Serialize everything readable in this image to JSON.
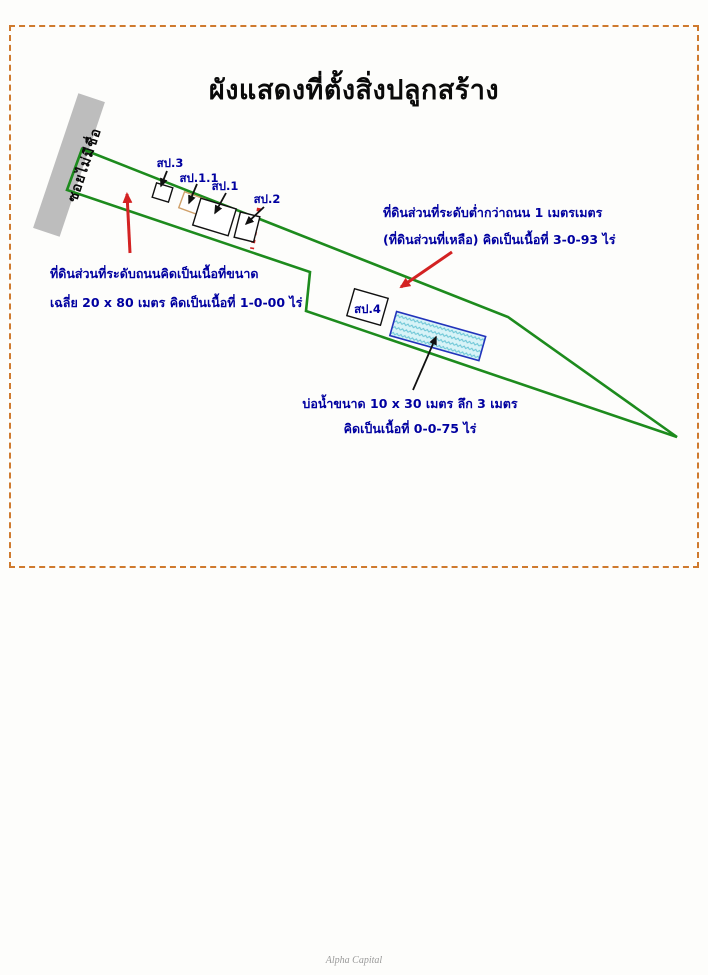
{
  "page": {
    "title": "ผังแสดงที่ตั้งสิ่งปลูกสร้าง",
    "footer": "Alpha Capital"
  },
  "road": {
    "label": "ซอยไม่มีชื่อ"
  },
  "buildings": [
    {
      "id": "sp3",
      "label": "สป.3"
    },
    {
      "id": "sp11",
      "label": "สป.1.1"
    },
    {
      "id": "sp1",
      "label": "สป.1"
    },
    {
      "id": "sp2",
      "label": "สป.2"
    },
    {
      "id": "sp4",
      "label": "สป.4"
    }
  ],
  "notes": {
    "road_level": {
      "line1": "ที่ดินส่วนที่ระดับถนนคิดเป็นเนื้อที่ขนาด",
      "line2": "เฉลี่ย 20 x 80 เมตร คิดเป็นเนื้อที่ 1-0-00 ไร่"
    },
    "lower_level": {
      "line1": "ที่ดินส่วนที่ระดับต่ำกว่าถนน 1 เมตรเมตร",
      "line2": "(ที่ดินส่วนที่เหลือ) คิดเป็นเนื้อที่ 3-0-93 ไร่"
    },
    "pond": {
      "line1": "บ่อน้ำขนาด 10 x 30 เมตร ลึก 3 เมตร",
      "line2": "คิดเป็นเนื้อที่ 0-0-75 ไร่"
    }
  },
  "colors": {
    "boundary_green": "#1d8b1d",
    "annotation_blue": "#0000a0",
    "arrow_red": "#d32222",
    "frame_orange": "#cf7a2e",
    "road_gray": "#bdbdbd",
    "outbuilding_tan": "#cfa06a",
    "pond_border_blue": "#2233bb",
    "pond_fill_cyan": "#d8f3f7"
  }
}
